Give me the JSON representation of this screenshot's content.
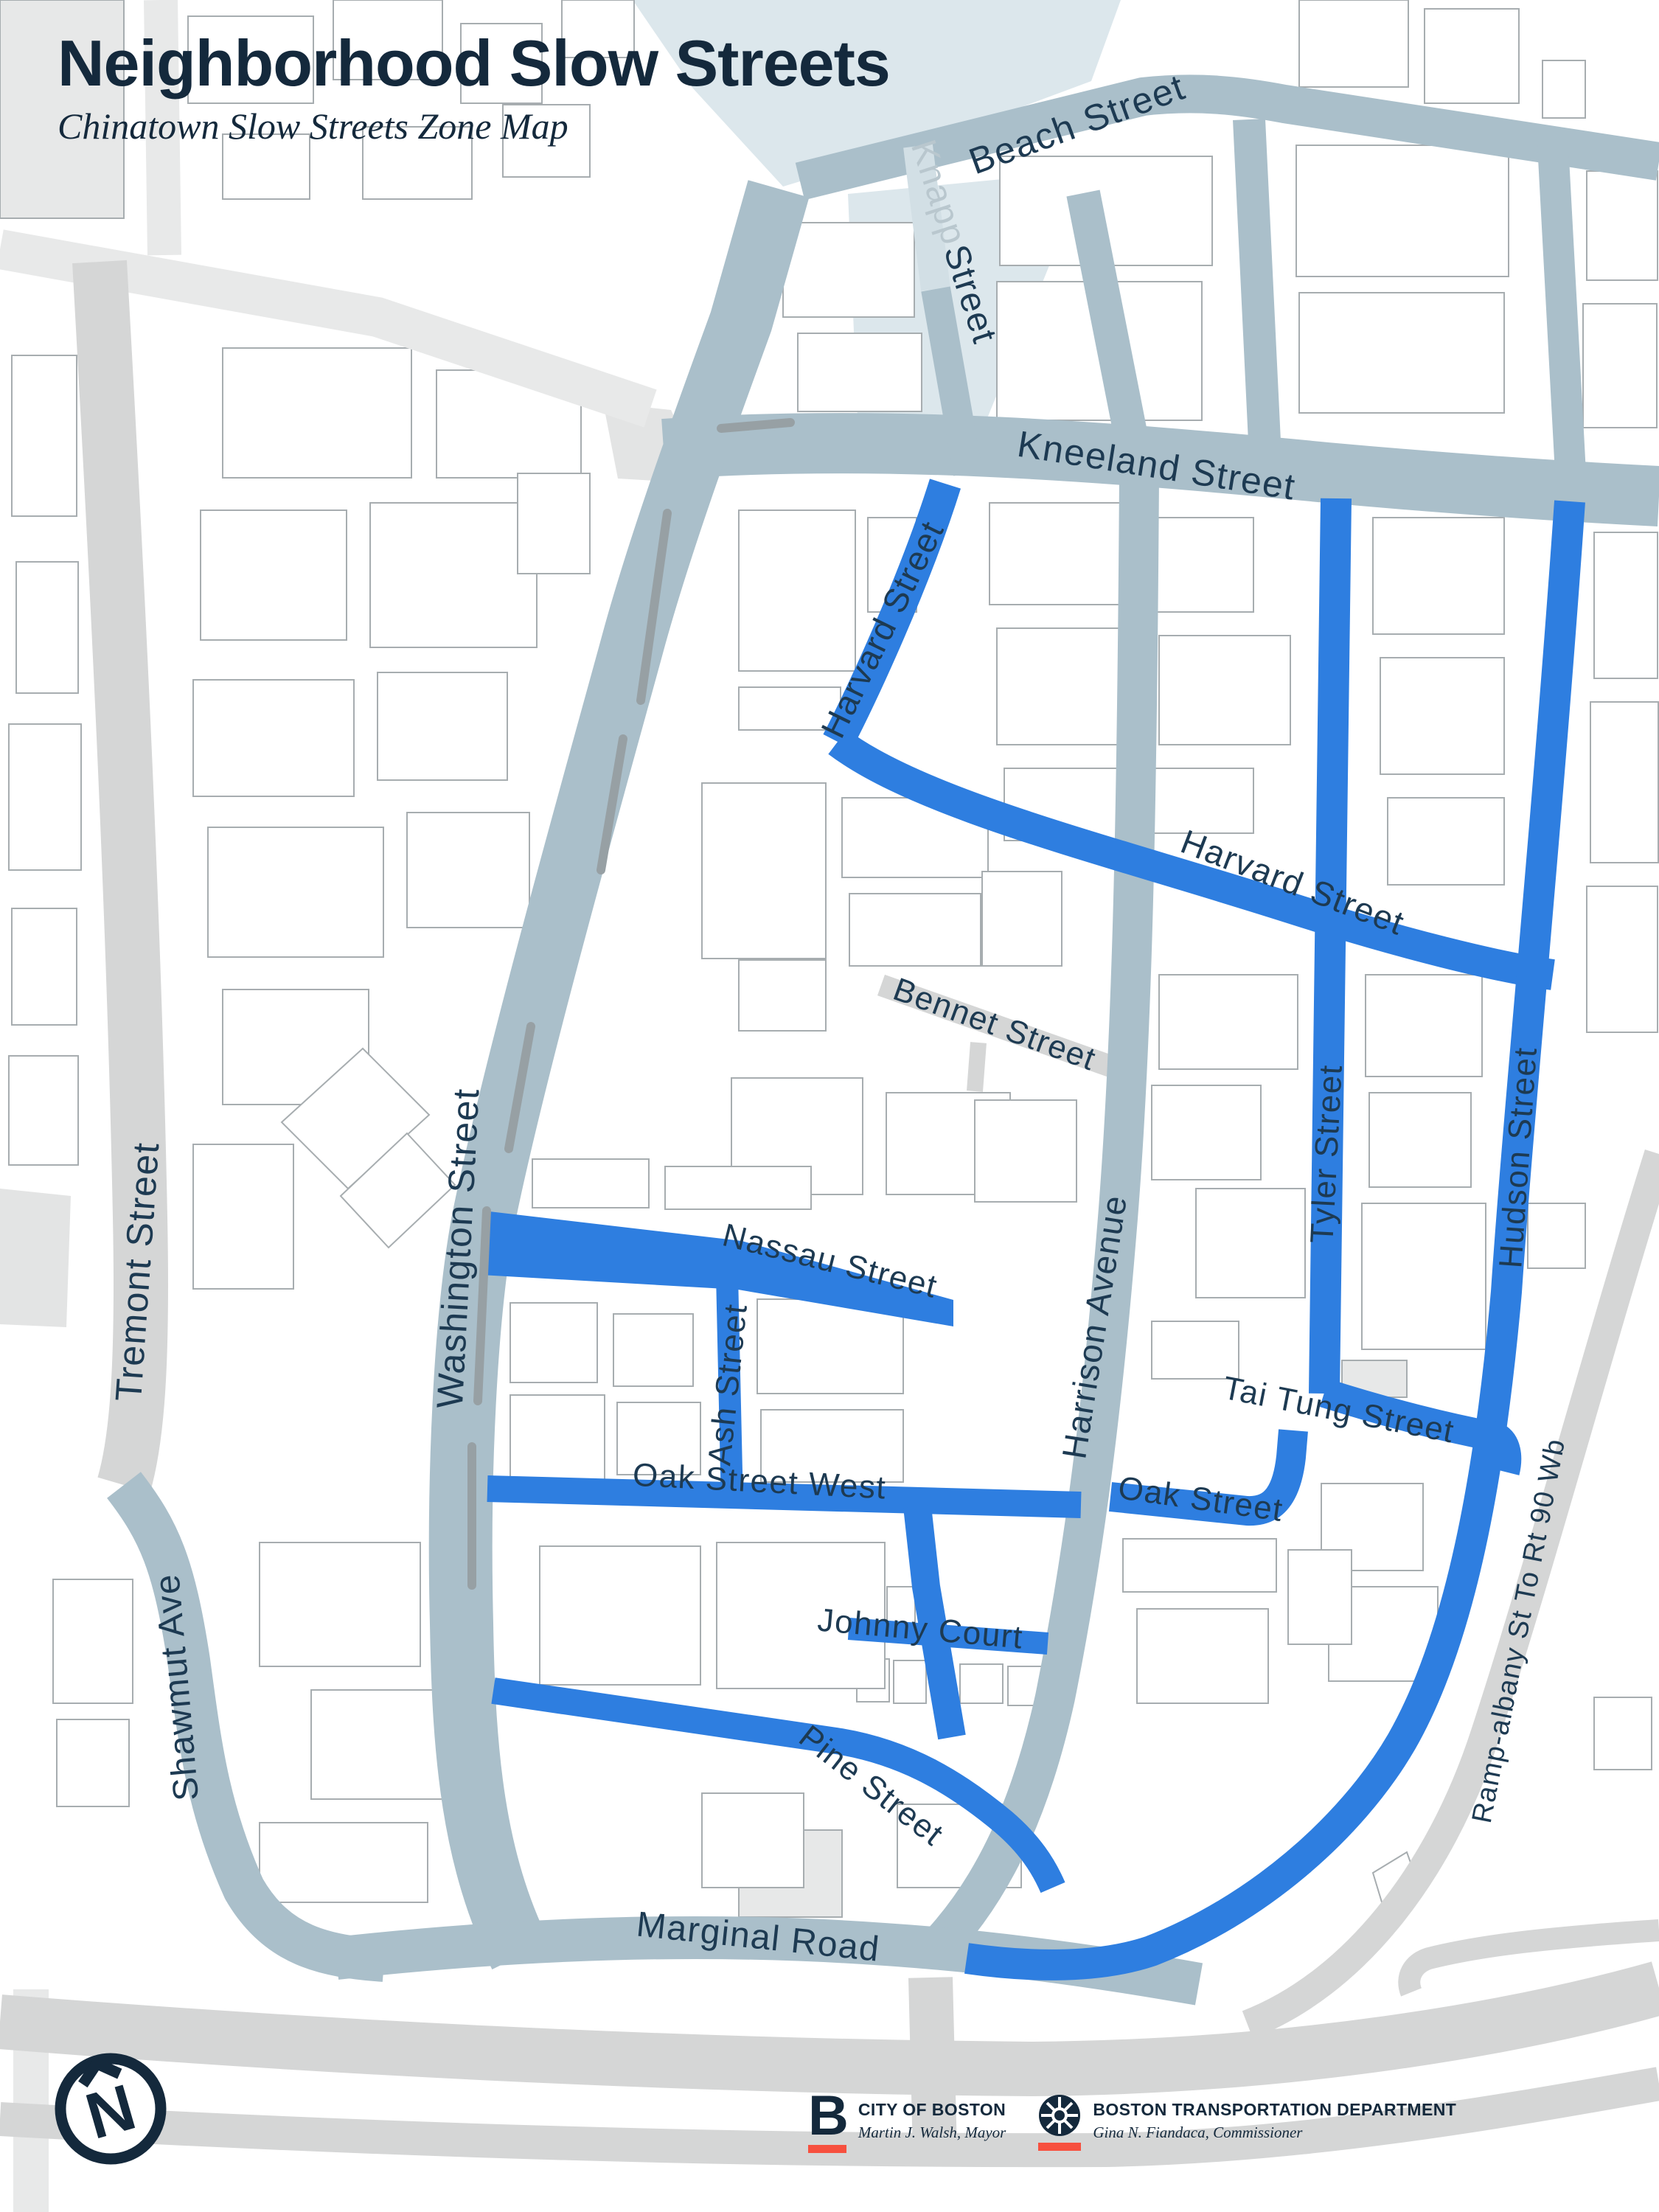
{
  "title": "Neighborhood Slow Streets",
  "subtitle": "Chinatown Slow Streets Zone Map",
  "colors": {
    "navy": "#14293c",
    "label": "#1d3a52",
    "slow_blue": "#2e7ee0",
    "street_main": "#aabfca",
    "street_gray": "#d5d6d6",
    "street_light": "#e8e9e9",
    "zone_pale": "#dce7ec",
    "zone_street": "#d2dfe5",
    "knapp_gray": "#b9c7ce",
    "red": "#f7503f"
  },
  "compass": {
    "letter": "N"
  },
  "street_labels": [
    {
      "id": "beach-street",
      "text": "Beach Street"
    },
    {
      "id": "knapp-a",
      "text": "Knapp"
    },
    {
      "id": "knapp-b",
      "text": "Street"
    },
    {
      "id": "kneeland-street",
      "text": "Kneeland Street"
    },
    {
      "id": "harvard-street-upper",
      "text": "Harvard Street"
    },
    {
      "id": "harvard-street-lower",
      "text": "Harvard Street"
    },
    {
      "id": "bennet-street",
      "text": "Bennet Street"
    },
    {
      "id": "tyler-street",
      "text": "Tyler Street"
    },
    {
      "id": "hudson-street",
      "text": "Hudson Street"
    },
    {
      "id": "washington-street",
      "text": "Washington Street"
    },
    {
      "id": "tremont-street",
      "text": "Tremont Street"
    },
    {
      "id": "harrison-avenue",
      "text": "Harrison Avenue"
    },
    {
      "id": "nassau-street",
      "text": "Nassau Street"
    },
    {
      "id": "ash-street",
      "text": "Ash Street"
    },
    {
      "id": "oak-street-west",
      "text": "Oak Street West"
    },
    {
      "id": "oak-street",
      "text": "Oak Street"
    },
    {
      "id": "tai-tung-street",
      "text": "Tai Tung Street"
    },
    {
      "id": "johnny-court",
      "text": "Johnny Court"
    },
    {
      "id": "pine-street",
      "text": "Pine Street"
    },
    {
      "id": "shawmut-ave",
      "text": "Shawmut Ave"
    },
    {
      "id": "marginal-road",
      "text": "Marginal Road"
    },
    {
      "id": "ramp-albany",
      "text": "Ramp-albany St To Rt 90 Wb"
    }
  ],
  "footer": {
    "city": {
      "initial": "B",
      "name": "CITY OF BOSTON",
      "person": "Martin J. Walsh, Mayor"
    },
    "btd": {
      "name": "BOSTON TRANSPORTATION DEPARTMENT",
      "person": "Gina N. Fiandaca, Commissioner"
    }
  }
}
